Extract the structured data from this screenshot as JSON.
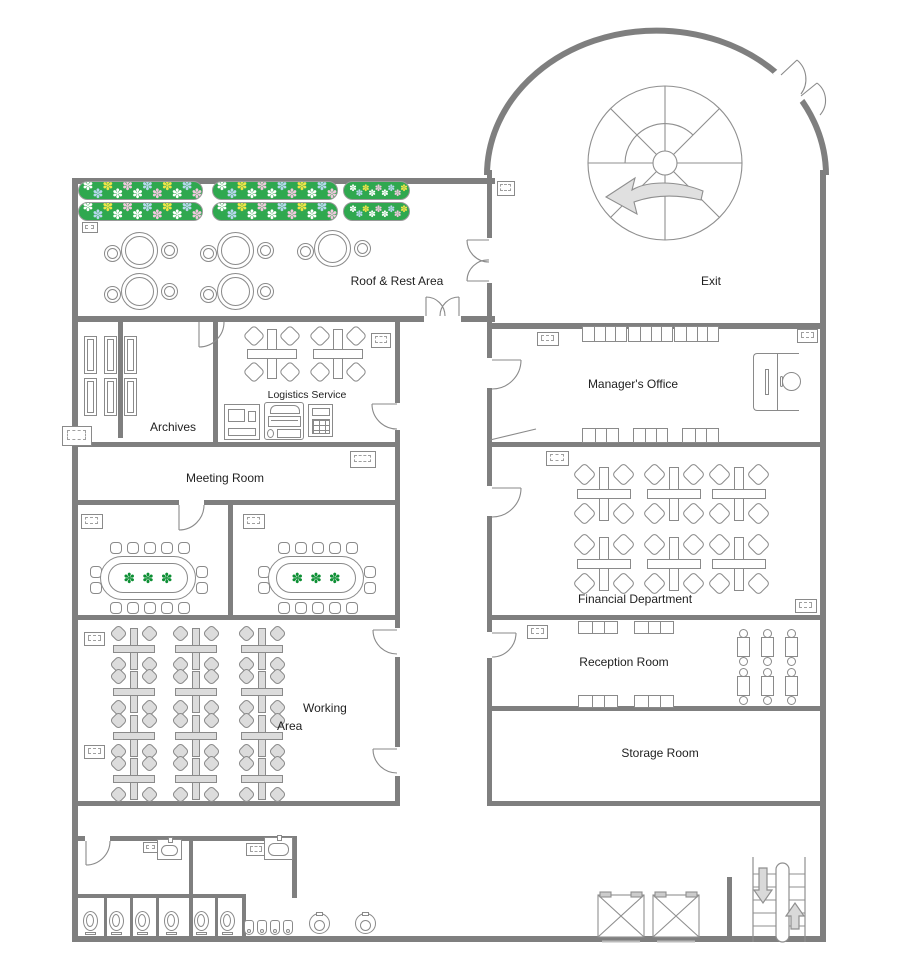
{
  "title": "Office Floor Plan",
  "colors": {
    "wall": "#7f7f7f",
    "line": "#8a8a8a",
    "desk_fill": "#dcdcdc",
    "bed_green": "#2fa84f",
    "plant_green": "#0d8f34",
    "flowers": [
      "#ffffff",
      "#f3e44a",
      "#f2c8df",
      "#b9d7ef"
    ],
    "arrow_fill": "#e0e0e0",
    "text": "#1f1f1f"
  },
  "rooms": {
    "roof_rest": {
      "label": "Roof & Rest Area"
    },
    "exit": {
      "label": "Exit"
    },
    "archives": {
      "label": "Archives"
    },
    "logistics": {
      "label": "Logistics Service"
    },
    "managers_office": {
      "label": "Manager's Office"
    },
    "meeting": {
      "label": "Meeting Room"
    },
    "working": {
      "label1": "Working",
      "label2": "Area"
    },
    "financial": {
      "label": "Financial Department"
    },
    "reception": {
      "label": "Reception Room"
    },
    "storage": {
      "label": "Storage Room"
    }
  },
  "furniture_counts": {
    "flower_beds": 6,
    "rest_round_tables": 5,
    "archive_shelves": 6,
    "logistics_desk_clusters": 2,
    "financial_desk_clusters": 6,
    "working_desk_clusters": 12,
    "conference_tables": 2,
    "chairs_per_conference_table": 14,
    "manager_sofa_benches": 6,
    "reception_benches": 4,
    "reception_guest_seats": 6,
    "toilets": 6,
    "urinals": 4,
    "sinks": 2,
    "elevators": 2,
    "staircases": 2
  }
}
